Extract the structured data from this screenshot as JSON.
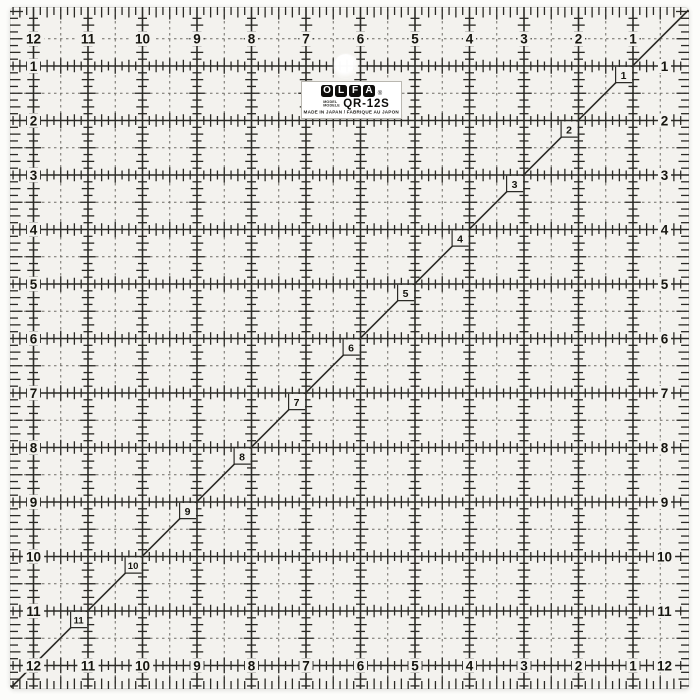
{
  "product": {
    "name": "OLFA QR-12S square quilting ruler"
  },
  "scales": {
    "top": [
      "12",
      "11",
      "10",
      "9",
      "8",
      "7",
      "6",
      "5",
      "4",
      "3",
      "2",
      "1"
    ],
    "left": [
      "1",
      "2",
      "3",
      "4",
      "5",
      "6",
      "7",
      "8",
      "9",
      "10",
      "11"
    ],
    "right": [
      "1",
      "2",
      "3",
      "4",
      "5",
      "6",
      "7",
      "8",
      "9",
      "10",
      "11",
      "12"
    ],
    "bottom": [
      "12",
      "11",
      "10",
      "9",
      "8",
      "7",
      "6",
      "5",
      "4",
      "3",
      "2",
      "1"
    ],
    "diagonal": [
      "1",
      "2",
      "3",
      "4",
      "5",
      "6",
      "7",
      "8",
      "9",
      "10",
      "11"
    ]
  },
  "label": {
    "brand_letters": [
      "O",
      "L",
      "F",
      "A"
    ],
    "registered_mark": "®",
    "model_caption_line1": "MODEL",
    "model_caption_line2": "MODELE",
    "model_number": "QR-12S",
    "origin_text": "MADE IN JAPAN / FABRIQUE AU JAPON"
  },
  "colors": {
    "scene_bg": "#fcfcfa",
    "ruler_bg": "#f3f2ee",
    "grid_line": "#2b2a26",
    "dashed_line": "#6f6d66",
    "number": "#16150f",
    "sticker_bg": "#ffffff",
    "logo_tile": "#0e0d0b",
    "logo_letter": "#ffffff"
  }
}
